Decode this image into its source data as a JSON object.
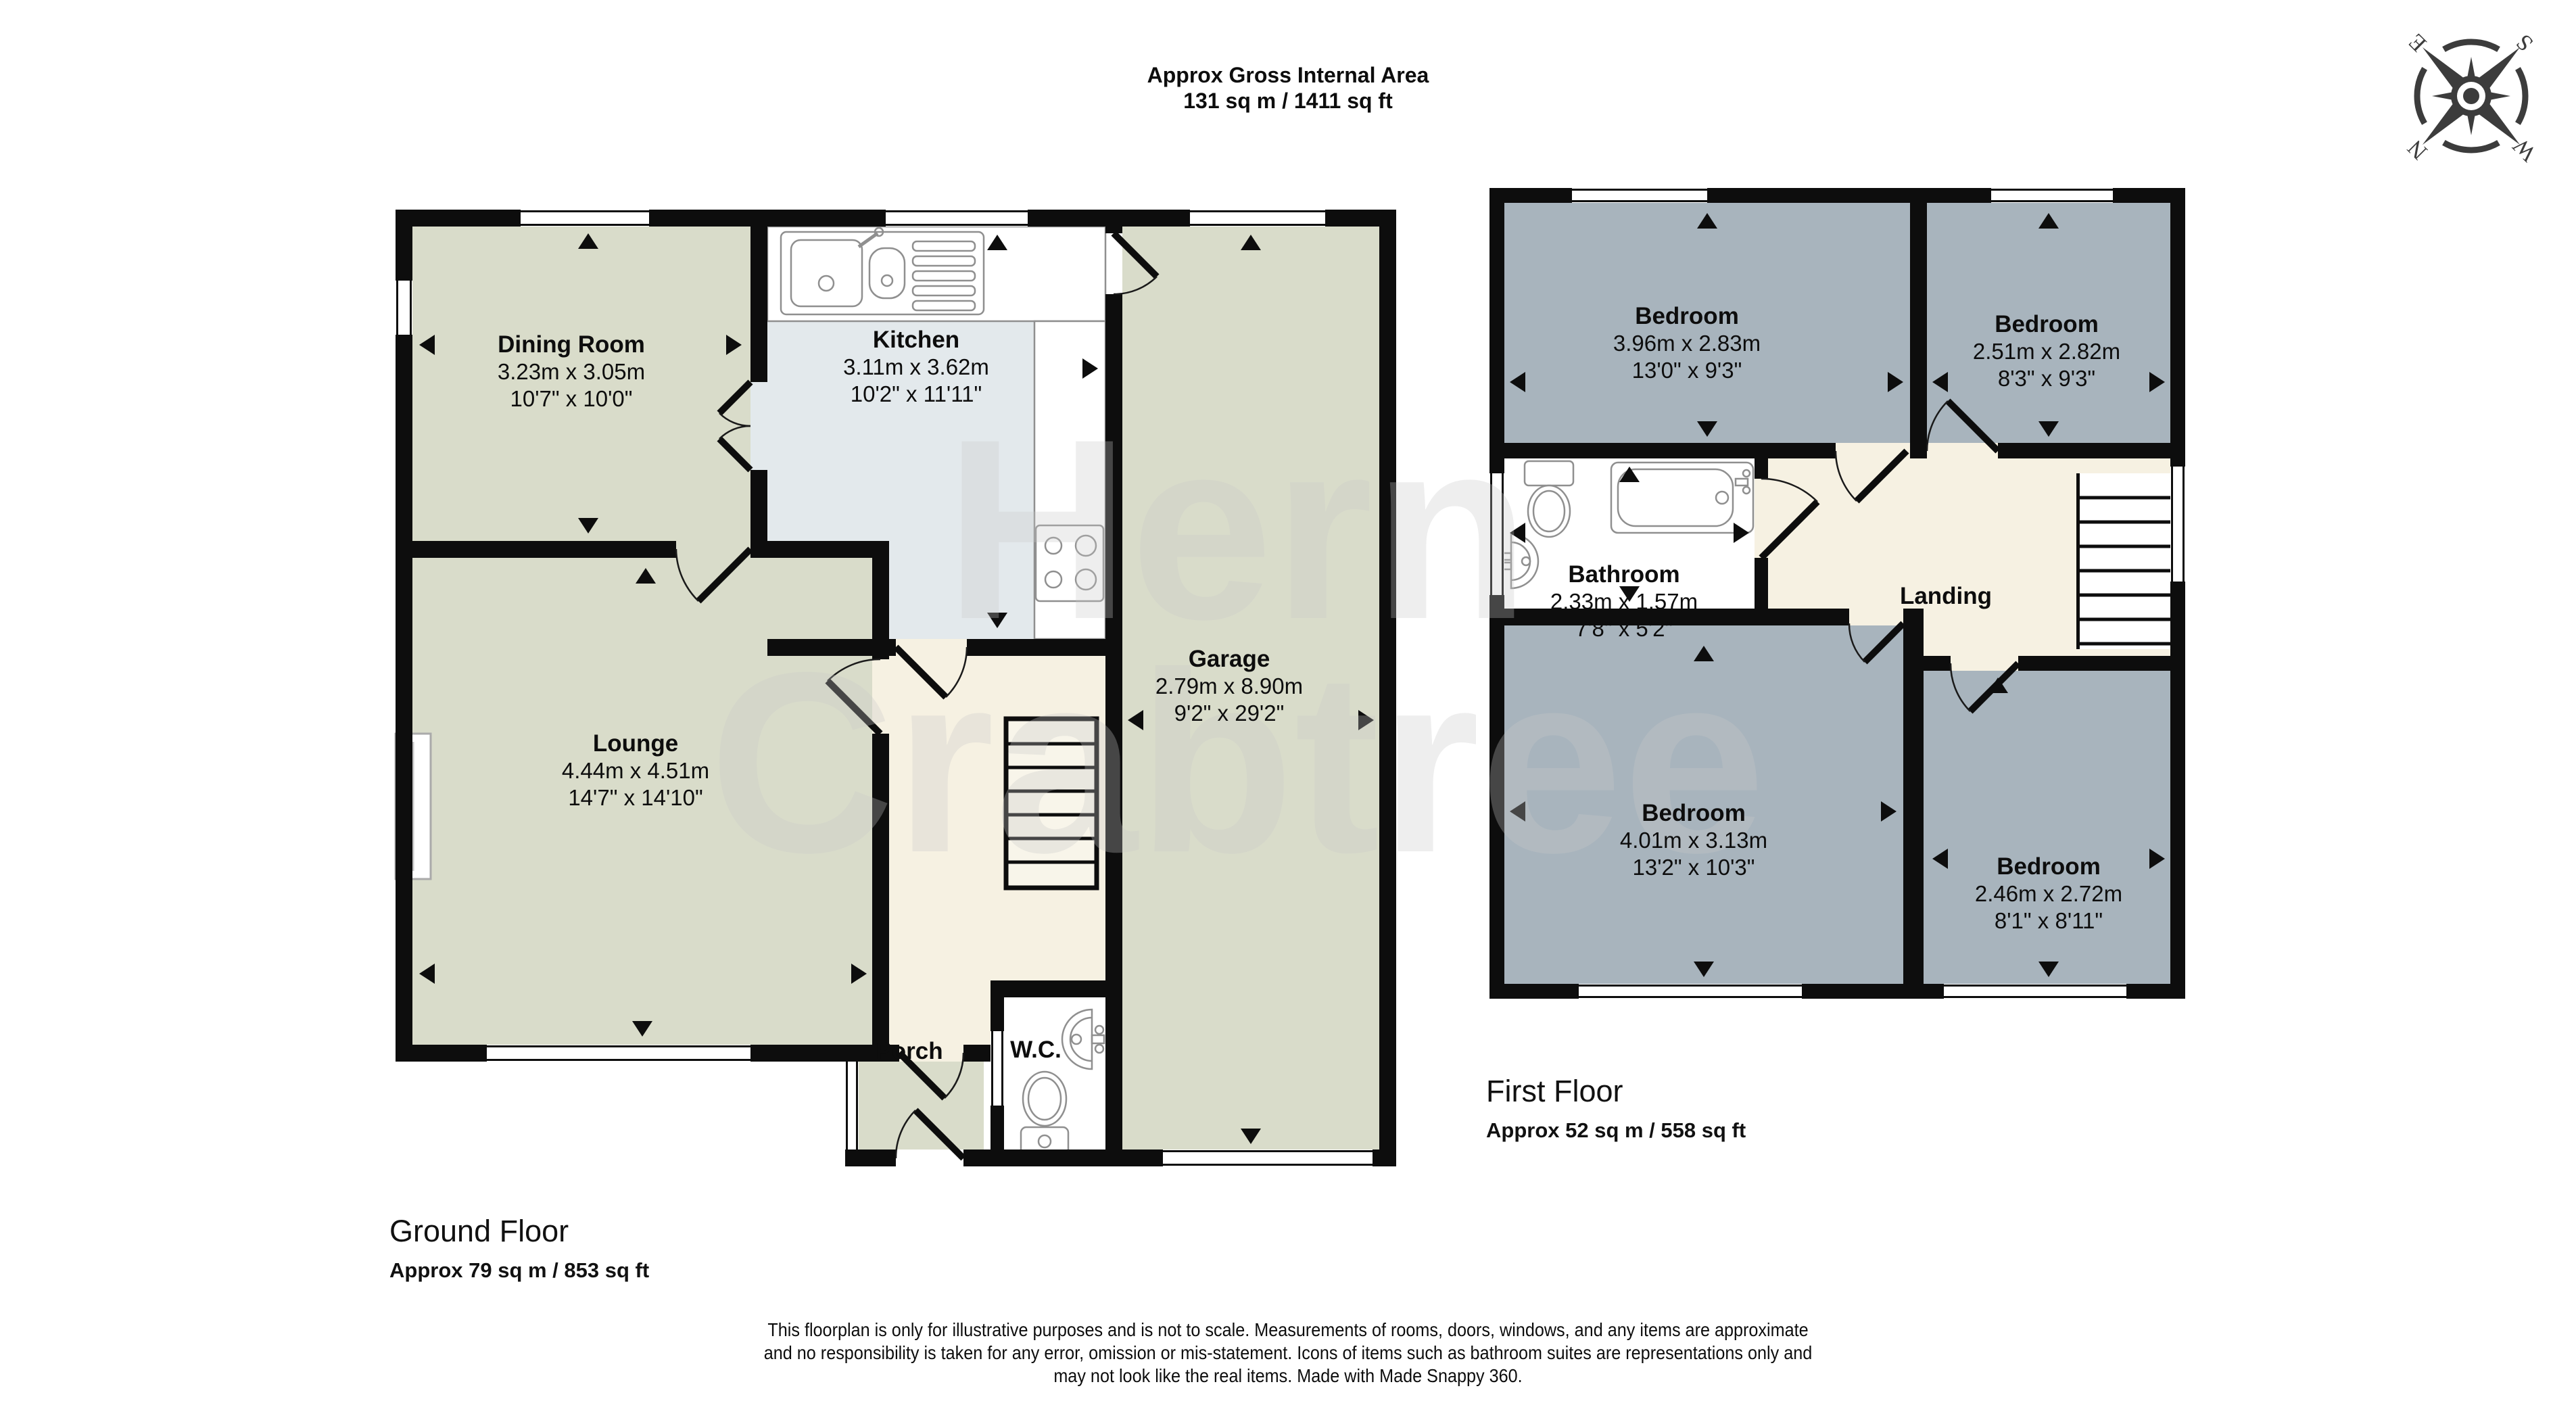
{
  "header": {
    "line1": "Approx Gross Internal Area",
    "line2": "131 sq m / 1411 sq ft"
  },
  "compass": {
    "n": "N",
    "e": "E",
    "s": "S",
    "w": "W"
  },
  "watermark": {
    "line1": "Hern",
    "line2": "Crabtree"
  },
  "ground_floor": {
    "label": "Ground Floor",
    "area": "Approx 79 sq m / 853 sq ft",
    "rooms": {
      "dining": {
        "name": "Dining Room",
        "metric": "3.23m x 3.05m",
        "imperial": "10'7\" x 10'0\""
      },
      "kitchen": {
        "name": "Kitchen",
        "metric": "3.11m x 3.62m",
        "imperial": "10'2\" x 11'11\""
      },
      "lounge": {
        "name": "Lounge",
        "metric": "4.44m x 4.51m",
        "imperial": "14'7\" x 14'10\""
      },
      "garage": {
        "name": "Garage",
        "metric": "2.79m x 8.90m",
        "imperial": "9'2\" x 29'2\""
      },
      "porch": {
        "name": "Porch"
      },
      "wc": {
        "name": "W.C."
      }
    }
  },
  "first_floor": {
    "label": "First Floor",
    "area": "Approx 52 sq m / 558 sq ft",
    "rooms": {
      "bedroom1": {
        "name": "Bedroom",
        "metric": "3.96m x 2.83m",
        "imperial": "13'0\" x 9'3\""
      },
      "bedroom2": {
        "name": "Bedroom",
        "metric": "2.51m x 2.82m",
        "imperial": "8'3\" x 9'3\""
      },
      "bathroom": {
        "name": "Bathroom",
        "metric": "2.33m x 1.57m",
        "imperial": "7'8\" x 5'2\""
      },
      "landing": {
        "name": "Landing"
      },
      "bedroom3": {
        "name": "Bedroom",
        "metric": "4.01m x 3.13m",
        "imperial": "13'2\" x 10'3\""
      },
      "bedroom4": {
        "name": "Bedroom",
        "metric": "2.46m x 2.72m",
        "imperial": "8'1\" x 8'11\""
      }
    }
  },
  "footer": {
    "line1": "This floorplan is only for illustrative purposes and is not to scale. Measurements of rooms, doors, windows, and any items are approximate",
    "line2": "and no responsibility is taken for any error, omission or mis-statement. Icons of items such as bathroom suites are representations only and",
    "line3": "may not look like the real items. Made with Made Snappy 360."
  },
  "colors": {
    "wall": "#0d0d0d",
    "sage_room": "#d9dcca",
    "kitchen_blue": "#e3e9ec",
    "hall_cream": "#f6f1e2",
    "bedroom_blue": "#a8b4bd",
    "bathroom_white": "#ffffff"
  }
}
